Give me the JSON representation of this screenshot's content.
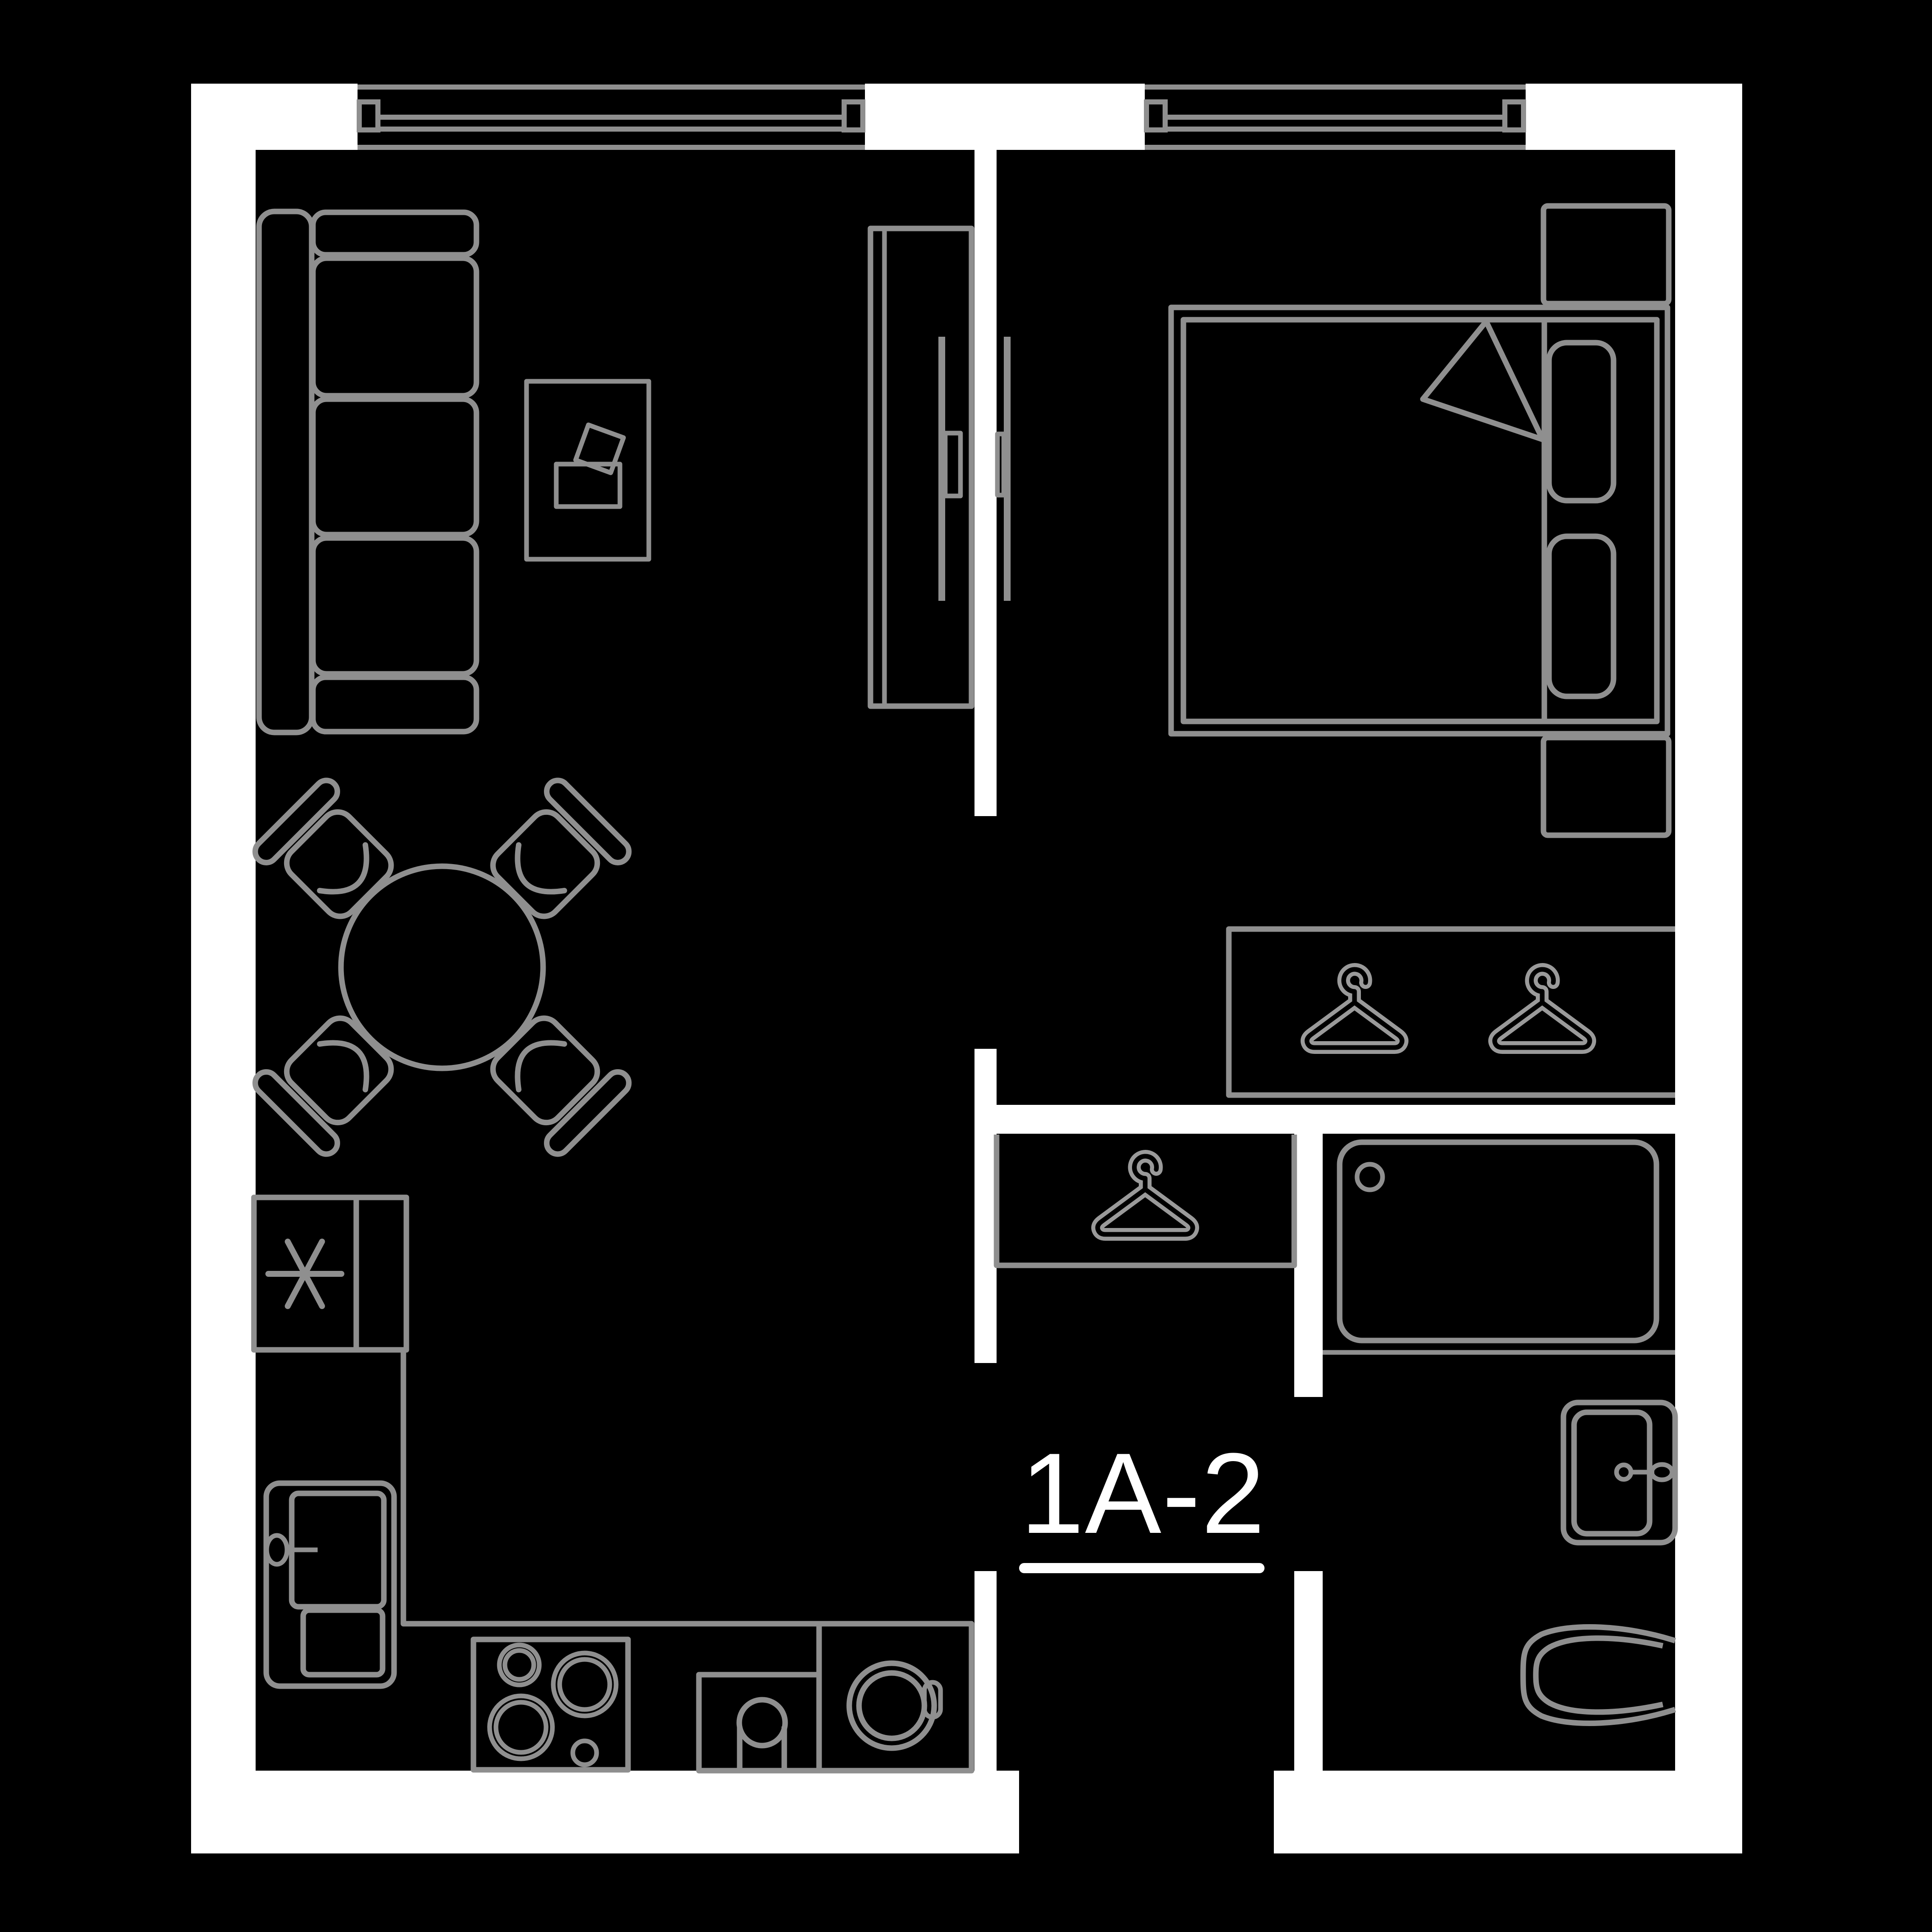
{
  "unit": {
    "label": "1A-2"
  },
  "colors": {
    "background": "#000000",
    "walls": "#ffffff",
    "furniture_lines": "#8f8f8f",
    "hanger_lines": "#9a9a9a",
    "label_text": "#ffffff"
  },
  "icons": {
    "hanger": {
      "name": "hanger-icon",
      "count": 3
    },
    "freezer_marker": {
      "name": "asterisk-icon",
      "count": 1
    }
  }
}
